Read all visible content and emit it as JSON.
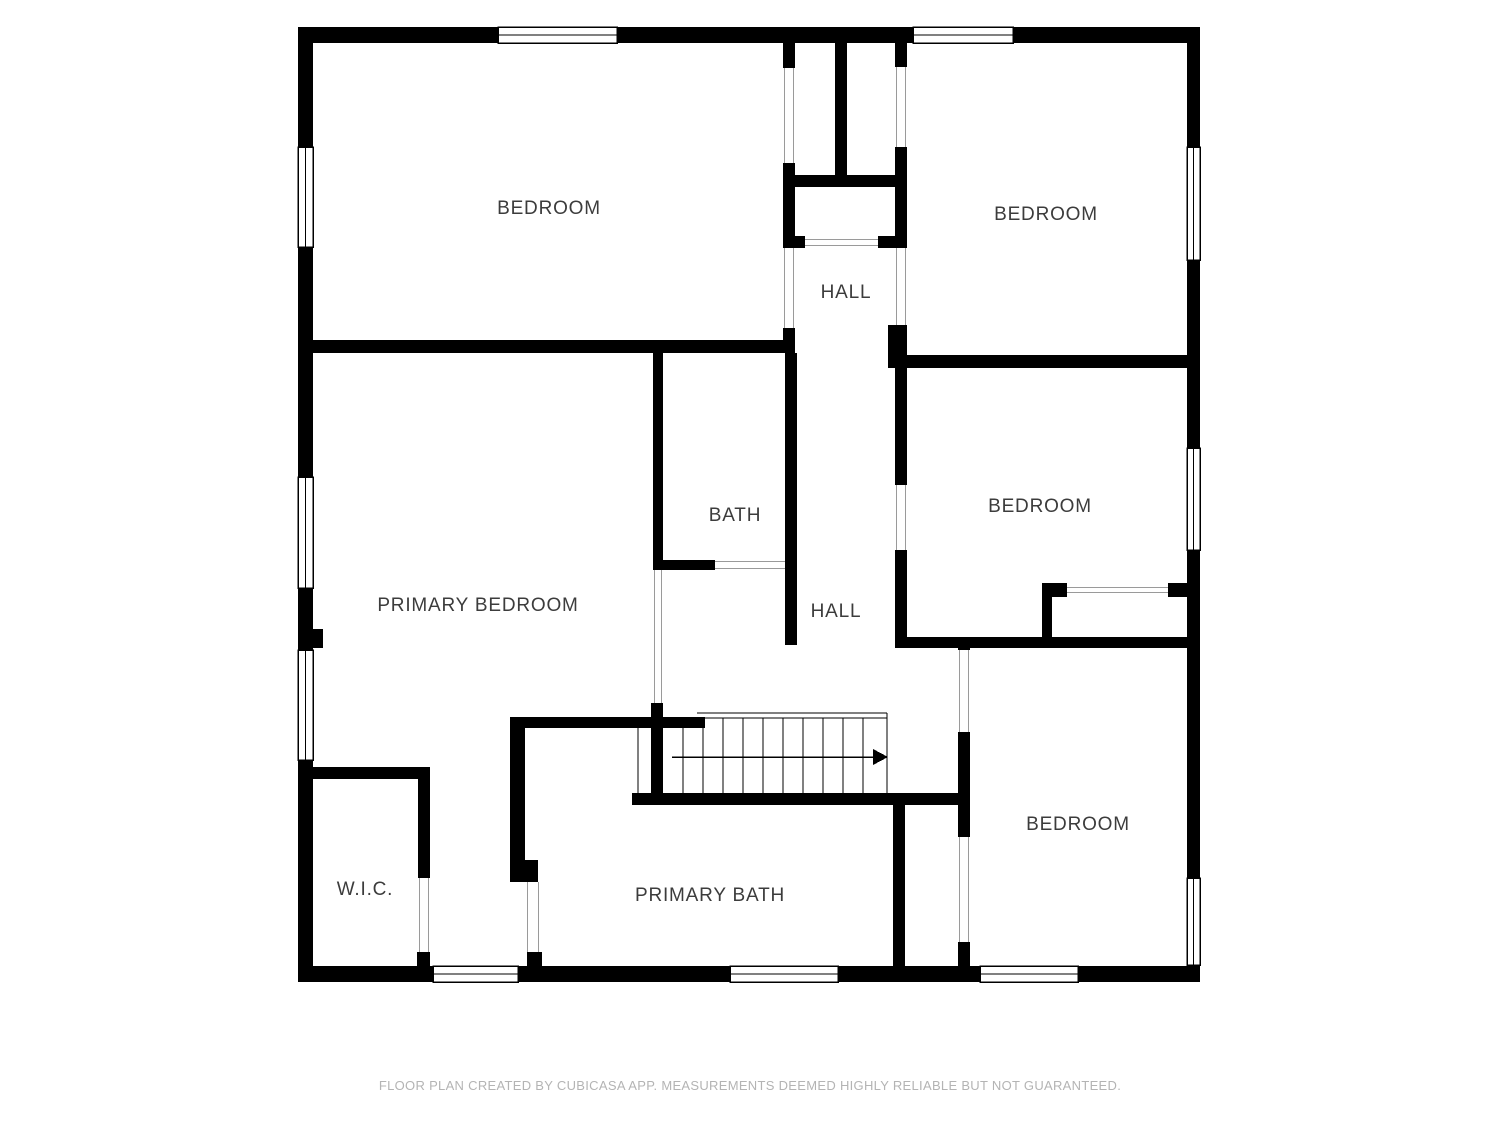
{
  "rooms": [
    {
      "id": "bedroom-top-left",
      "label": "BEDROOM"
    },
    {
      "id": "bedroom-top-right",
      "label": "BEDROOM"
    },
    {
      "id": "hall-upper",
      "label": "HALL"
    },
    {
      "id": "bath",
      "label": "BATH"
    },
    {
      "id": "bedroom-mid-right",
      "label": "BEDROOM"
    },
    {
      "id": "primary-bedroom",
      "label": "PRIMARY BEDROOM"
    },
    {
      "id": "hall-lower",
      "label": "HALL"
    },
    {
      "id": "wic",
      "label": "W.I.C."
    },
    {
      "id": "primary-bath",
      "label": "PRIMARY BATH"
    },
    {
      "id": "bedroom-bottom-right",
      "label": "BEDROOM"
    }
  ],
  "footer": {
    "disclaimer": "FLOOR PLAN CREATED BY CUBICASA APP. MEASUREMENTS DEEMED HIGHLY RELIABLE BUT NOT GUARANTEED."
  },
  "icons": {
    "stairs_direction_arrow": "→"
  },
  "colors": {
    "wall": "#000000",
    "label_text": "#3c3c3c",
    "footer_text": "#b4b4b4",
    "opening_line": "#9a9a9a",
    "background": "#ffffff"
  }
}
